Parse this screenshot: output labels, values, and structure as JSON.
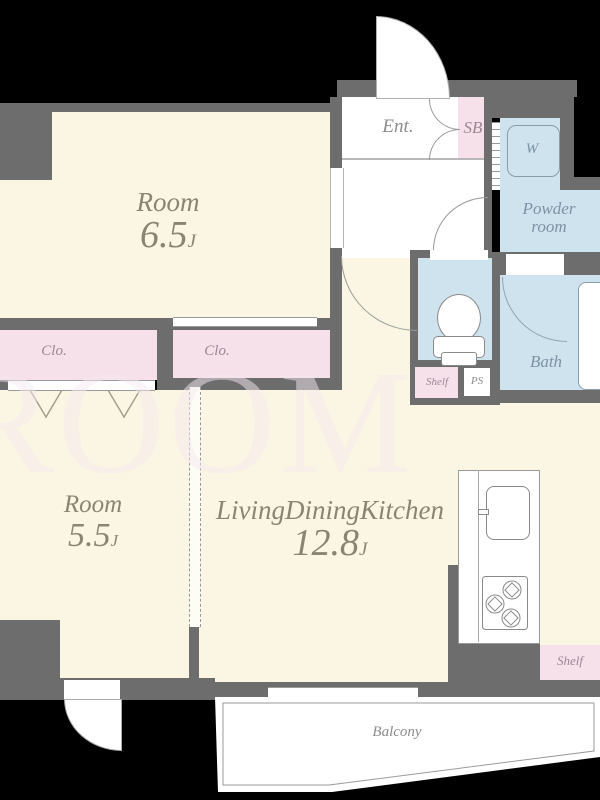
{
  "rooms": {
    "room_6_5": {
      "name": "Room",
      "size": "6.5",
      "suffix": "J"
    },
    "room_5_5": {
      "name": "Room",
      "size": "5.5",
      "suffix": "J"
    },
    "ldk": {
      "name": "LivingDiningKitchen",
      "size": "12.8",
      "suffix": "J"
    },
    "entrance": "Ent.",
    "shoe_box": "SB",
    "washer": "W",
    "powder_line1": "Powder",
    "powder_line2": "room",
    "bath": "Bath",
    "closet_1": "Clo.",
    "closet_2": "Clo.",
    "shelf_hall": "Shelf",
    "pipe_space": "PS",
    "shelf_kitchen": "Shelf",
    "balcony": "Balcony"
  },
  "watermark": "ROOM CORE",
  "colors": {
    "background": "#000000",
    "wall": "#6d6d6d",
    "room_fill": "#faf6e3",
    "closet_fill": "#f6e1eb",
    "wet_area_fill": "#cfe3ef",
    "balcony_fill": "#ffffff"
  }
}
